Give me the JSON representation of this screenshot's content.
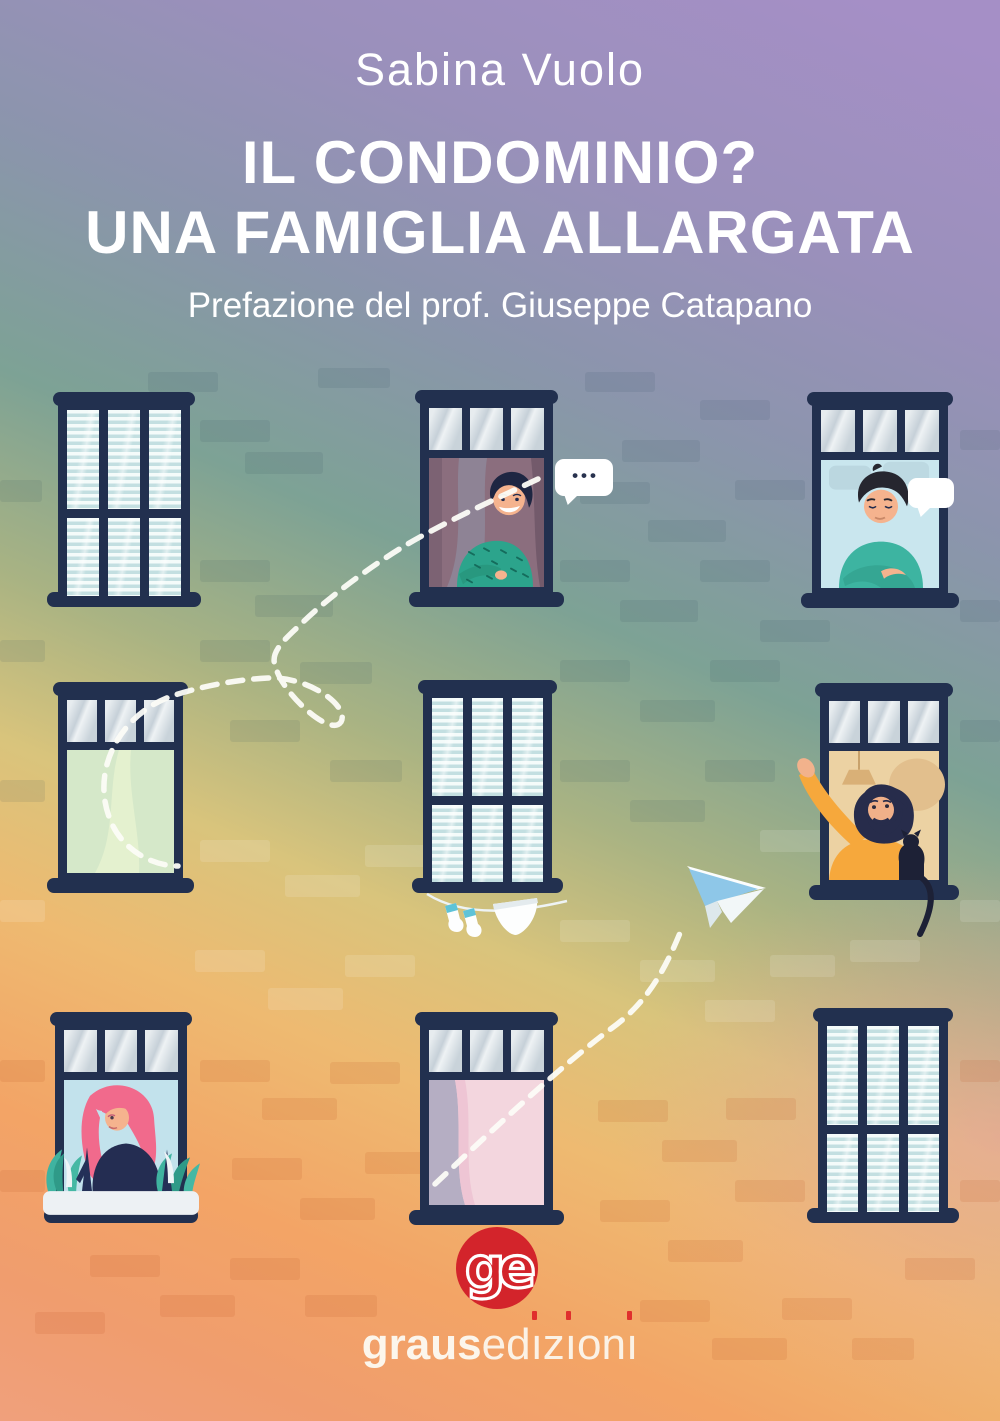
{
  "cover": {
    "author": "Sabina Vuolo",
    "title_line1": "IL CONDOMINIO?",
    "title_line2": "UNA FAMIGLIA ALLARGATA",
    "subtitle": "Prefazione del prof. Giuseppe Catapano"
  },
  "speech_bubbles": {
    "top_middle_text": "•••",
    "top_right_text": ""
  },
  "publisher": {
    "monogram": "ge",
    "name_bold": "graus",
    "name_light": "edizioni"
  },
  "colors": {
    "frame_navy": "#22304f",
    "logo_red": "#d3242b",
    "accent_dot_red": "#e02b2b",
    "plane_blue": "#8ec7e8",
    "dash_white": "#fcfcf7"
  }
}
